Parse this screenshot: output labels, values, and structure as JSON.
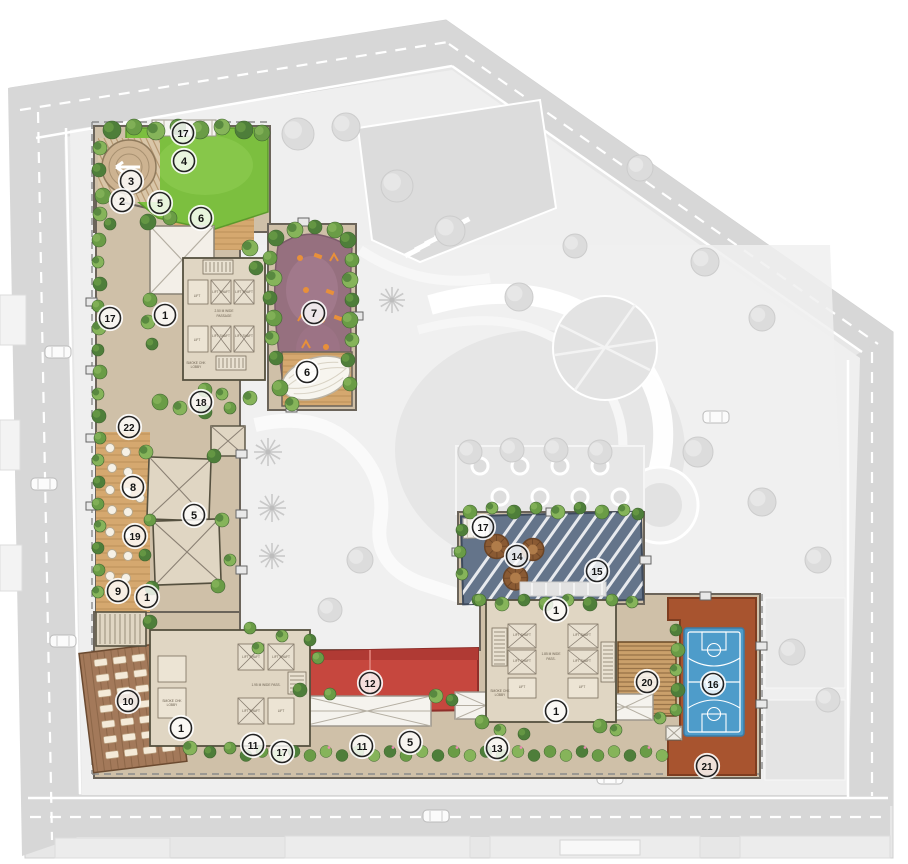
{
  "plan": {
    "title": "residential-site-master-plan",
    "markers": [
      {
        "n": "17",
        "x": 183,
        "y": 133
      },
      {
        "n": "4",
        "x": 184,
        "y": 161
      },
      {
        "n": "3",
        "x": 131,
        "y": 181
      },
      {
        "n": "2",
        "x": 122,
        "y": 201
      },
      {
        "n": "5",
        "x": 160,
        "y": 203
      },
      {
        "n": "6",
        "x": 201,
        "y": 218
      },
      {
        "n": "1",
        "x": 165,
        "y": 315
      },
      {
        "n": "17",
        "x": 110,
        "y": 318
      },
      {
        "n": "7",
        "x": 314,
        "y": 313
      },
      {
        "n": "6",
        "x": 307,
        "y": 372
      },
      {
        "n": "18",
        "x": 201,
        "y": 402
      },
      {
        "n": "22",
        "x": 129,
        "y": 427
      },
      {
        "n": "8",
        "x": 133,
        "y": 487
      },
      {
        "n": "5",
        "x": 194,
        "y": 515
      },
      {
        "n": "19",
        "x": 135,
        "y": 536
      },
      {
        "n": "9",
        "x": 118,
        "y": 591
      },
      {
        "n": "1",
        "x": 147,
        "y": 597
      },
      {
        "n": "10",
        "x": 128,
        "y": 701
      },
      {
        "n": "1",
        "x": 181,
        "y": 728
      },
      {
        "n": "11",
        "x": 253,
        "y": 745
      },
      {
        "n": "17",
        "x": 282,
        "y": 752
      },
      {
        "n": "11",
        "x": 362,
        "y": 746
      },
      {
        "n": "5",
        "x": 410,
        "y": 742
      },
      {
        "n": "12",
        "x": 370,
        "y": 683
      },
      {
        "n": "13",
        "x": 497,
        "y": 748
      },
      {
        "n": "17",
        "x": 483,
        "y": 527
      },
      {
        "n": "14",
        "x": 517,
        "y": 556
      },
      {
        "n": "15",
        "x": 597,
        "y": 571
      },
      {
        "n": "1",
        "x": 556,
        "y": 610
      },
      {
        "n": "20",
        "x": 647,
        "y": 682
      },
      {
        "n": "16",
        "x": 713,
        "y": 684
      },
      {
        "n": "1",
        "x": 556,
        "y": 711
      },
      {
        "n": "21",
        "x": 707,
        "y": 766
      }
    ],
    "floor_labels": [
      {
        "t": "LIFT",
        "x": 197,
        "y": 297
      },
      {
        "t": "LIFT SHAFT",
        "x": 221,
        "y": 293
      },
      {
        "t": "LIFT SHAFT",
        "x": 244,
        "y": 293
      },
      {
        "t": "2.50 M WIDE",
        "x": 224,
        "y": 312
      },
      {
        "t": "PASSAGE",
        "x": 224,
        "y": 317
      },
      {
        "t": "LIFT",
        "x": 197,
        "y": 341
      },
      {
        "t": "LIFT SHAFT",
        "x": 221,
        "y": 337
      },
      {
        "t": "LIFT SHAFT",
        "x": 244,
        "y": 337
      },
      {
        "t": "SMOKE CHK",
        "x": 196,
        "y": 364
      },
      {
        "t": "LOBBY",
        "x": 196,
        "y": 368
      },
      {
        "t": "LIFT SHAFT",
        "x": 251,
        "y": 658
      },
      {
        "t": "LIFT SHAFT",
        "x": 281,
        "y": 658
      },
      {
        "t": "1.95 M WIDE PASS.",
        "x": 266,
        "y": 686
      },
      {
        "t": "LIFT SHAFT",
        "x": 251,
        "y": 712
      },
      {
        "t": "LIFT",
        "x": 281,
        "y": 712
      },
      {
        "t": "SMOKE CHK",
        "x": 172,
        "y": 702
      },
      {
        "t": "LOBBY",
        "x": 172,
        "y": 706
      },
      {
        "t": "LIFT SHAFT",
        "x": 522,
        "y": 636
      },
      {
        "t": "LIFT SHAFT",
        "x": 582,
        "y": 636
      },
      {
        "t": "LIFT SHAFT",
        "x": 522,
        "y": 662
      },
      {
        "t": "LIFT SHAFT",
        "x": 582,
        "y": 662
      },
      {
        "t": "LIFT",
        "x": 522,
        "y": 688
      },
      {
        "t": "LIFT",
        "x": 582,
        "y": 688
      },
      {
        "t": "1.85 M WIDE",
        "x": 551,
        "y": 655
      },
      {
        "t": "PASS.",
        "x": 551,
        "y": 660
      },
      {
        "t": "SMOKE CHK",
        "x": 500,
        "y": 692
      },
      {
        "t": "LOBBY",
        "x": 500,
        "y": 696
      }
    ],
    "colors": {
      "lawn_green": "#7cbf3f",
      "playground_mauve": "#96707f",
      "highlight_red": "#c6473e",
      "court_blue": "#4e9cca",
      "court_terracotta": "#a8542f",
      "deck_wood": "#d5a86f",
      "path_tan": "#cfc0a8",
      "building_beige": "#e0d6c3",
      "deck_slate": "#64748a",
      "road_grey": "#d7d7d7",
      "surround_grey": "#ececec",
      "tree_green": "#5d8f3e",
      "marker_ink": "#222222"
    }
  }
}
